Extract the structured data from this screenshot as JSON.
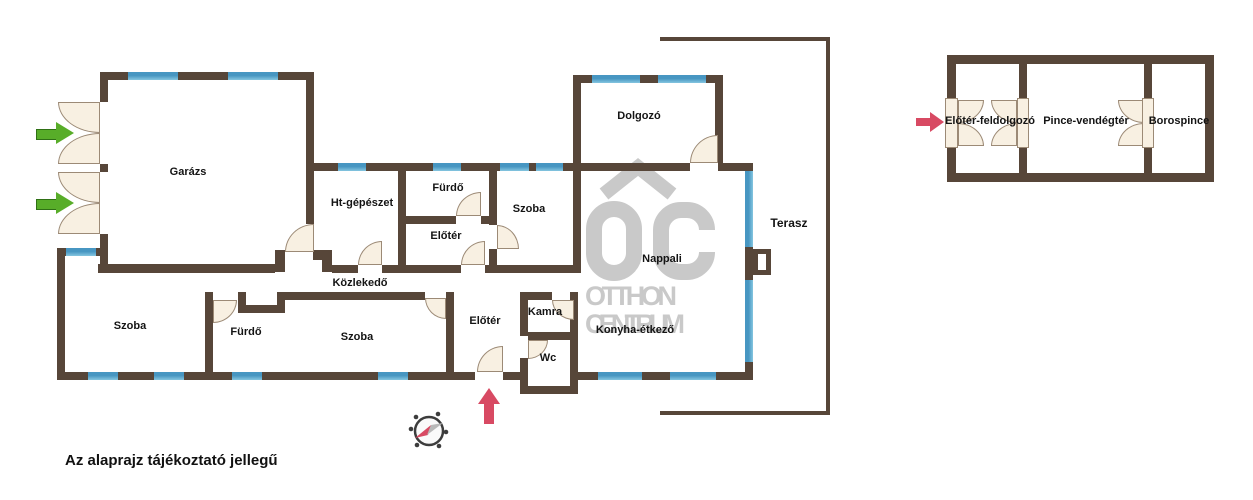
{
  "note": "Az alaprajz tájékoztató jellegű",
  "watermark": {
    "logo": "OC",
    "line1": "OTTHON",
    "line2": "CENTRUM"
  },
  "colors": {
    "wall": "#574639",
    "window_blue": "#4796c2",
    "window_blue_light": "#85c6e0",
    "door_fill": "#f8f0e2",
    "accent_pink": "#d84a63",
    "accent_green": "#58ad29",
    "watermark_gray": "#c9c9c9"
  },
  "main_floorplan": {
    "rooms": [
      {
        "label": "Garázs"
      },
      {
        "label": "Ht-gépészet"
      },
      {
        "label": "Fürdő"
      },
      {
        "label": "Szoba"
      },
      {
        "label": "Előtér"
      },
      {
        "label": "Közlekedő"
      },
      {
        "label": "Dolgozó"
      },
      {
        "label": "Nappali"
      },
      {
        "label": "Konyha-étkező"
      },
      {
        "label": "Terasz"
      },
      {
        "label": "Szoba"
      },
      {
        "label": "Fürdő"
      },
      {
        "label": "Szoba"
      },
      {
        "label": "Előtér"
      },
      {
        "label": "Kamra"
      },
      {
        "label": "Wc"
      }
    ]
  },
  "cellar_floorplan": {
    "rooms": [
      {
        "label": "Előtér-feldolgozó"
      },
      {
        "label": "Pince-vendégtér"
      },
      {
        "label": "Borospince"
      }
    ]
  }
}
